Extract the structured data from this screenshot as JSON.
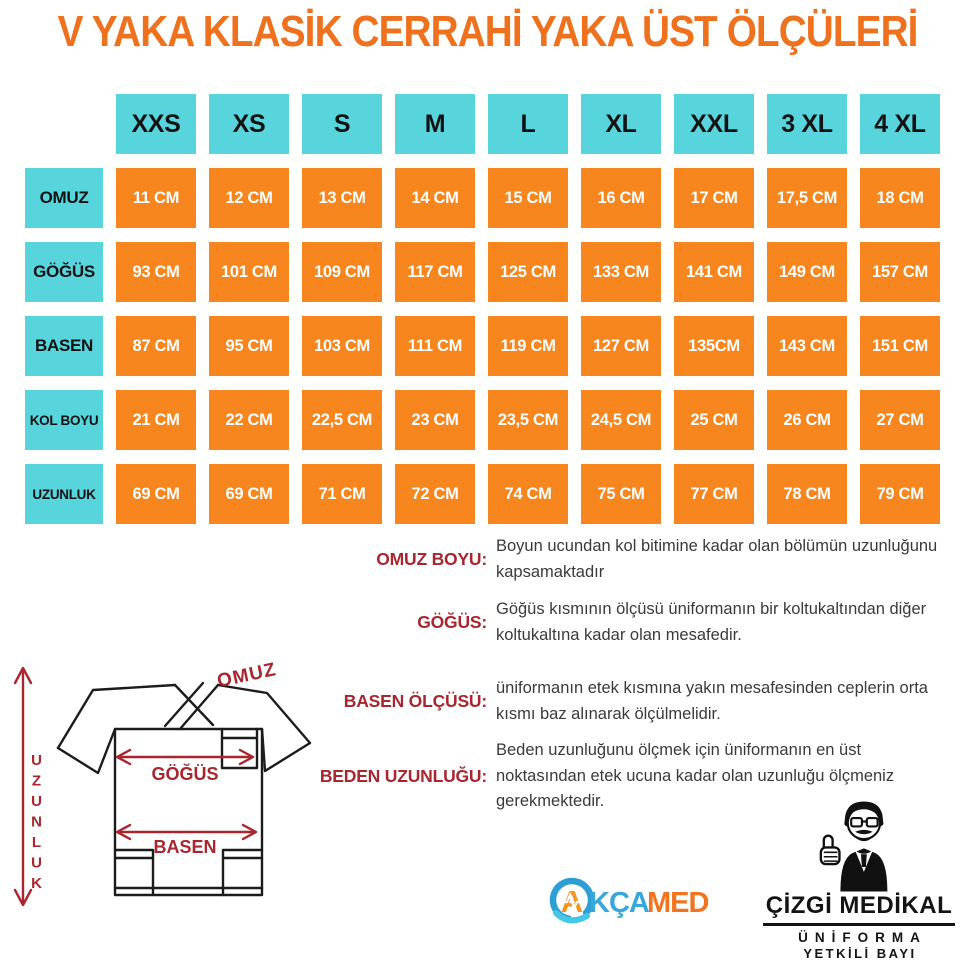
{
  "title": "V YAKA KLASİK CERRAHİ YAKA ÜST ÖLÇÜLERİ",
  "size_table": {
    "columns": [
      "XXS",
      "XS",
      "S",
      "M",
      "L",
      "XL",
      "XXL",
      "3 XL",
      "4 XL"
    ],
    "rows": [
      {
        "label": "OMUZ",
        "values": [
          "11 CM",
          "12 CM",
          "13 CM",
          "14 CM",
          "15 CM",
          "16 CM",
          "17 CM",
          "17,5 CM",
          "18 CM"
        ]
      },
      {
        "label": "GÖĞÜS",
        "values": [
          "93 CM",
          "101 CM",
          "109 CM",
          "117 CM",
          "125 CM",
          "133 CM",
          "141 CM",
          "149 CM",
          "157 CM"
        ]
      },
      {
        "label": "BASEN",
        "values": [
          "87 CM",
          "95 CM",
          "103 CM",
          "111 CM",
          "119 CM",
          "127 CM",
          "135CM",
          "143 CM",
          "151 CM"
        ]
      },
      {
        "label": "KOL BOYU",
        "values": [
          "21 CM",
          "22 CM",
          "22,5 CM",
          "23 CM",
          "23,5 CM",
          "24,5 CM",
          "25 CM",
          "26 CM",
          "27 CM"
        ]
      },
      {
        "label": "UZUNLUK",
        "values": [
          "69 CM",
          "69 CM",
          "71 CM",
          "72 CM",
          "74 CM",
          "75 CM",
          "77 CM",
          "78 CM",
          "79 CM"
        ]
      }
    ]
  },
  "definitions": [
    {
      "term": "OMUZ BOYU:",
      "description": "Boyun ucundan kol bitimine kadar olan bölümün uzunluğunu kapsamaktadır"
    },
    {
      "term": "GÖĞÜS:",
      "description": "Göğüs kısmının ölçüsü üniformanın bir koltukaltından diğer koltukaltına kadar olan mesafedir."
    },
    {
      "term": "BASEN ÖLÇÜSÜ:",
      "description": "üniformanın etek kısmına yakın mesafesinden ceplerin orta kısmı baz alınarak ölçülmelidir."
    },
    {
      "term": "BEDEN UZUNLUĞU:",
      "description": "Beden uzunluğunu ölçmek için üniformanın en üst noktasından etek ucuna kadar olan uzunluğu ölçmeniz gerekmektedir."
    }
  ],
  "diagram": {
    "labels": {
      "uzunluk": "UZUNLUK",
      "omuz": "OMUZ",
      "gogus": "GÖĞÜS",
      "basen": "BASEN"
    }
  },
  "logos": {
    "akcamed": {
      "part1": "A",
      "part2": "KÇA",
      "part3": "MED"
    },
    "cizgi": {
      "line1": "ÇİZGİ MEDİKAL",
      "line2": "ÜNİFORMA",
      "line3": "YETKİLİ BAYI"
    }
  },
  "colors": {
    "title_orange": "#F0711D",
    "cell_orange": "#F6861D",
    "header_cyan": "#57D4DC",
    "label_red": "#A9262E",
    "body_text": "#3A3A3A",
    "logo_blue": "#38A8DC",
    "logo_orange": "#F4731F"
  }
}
